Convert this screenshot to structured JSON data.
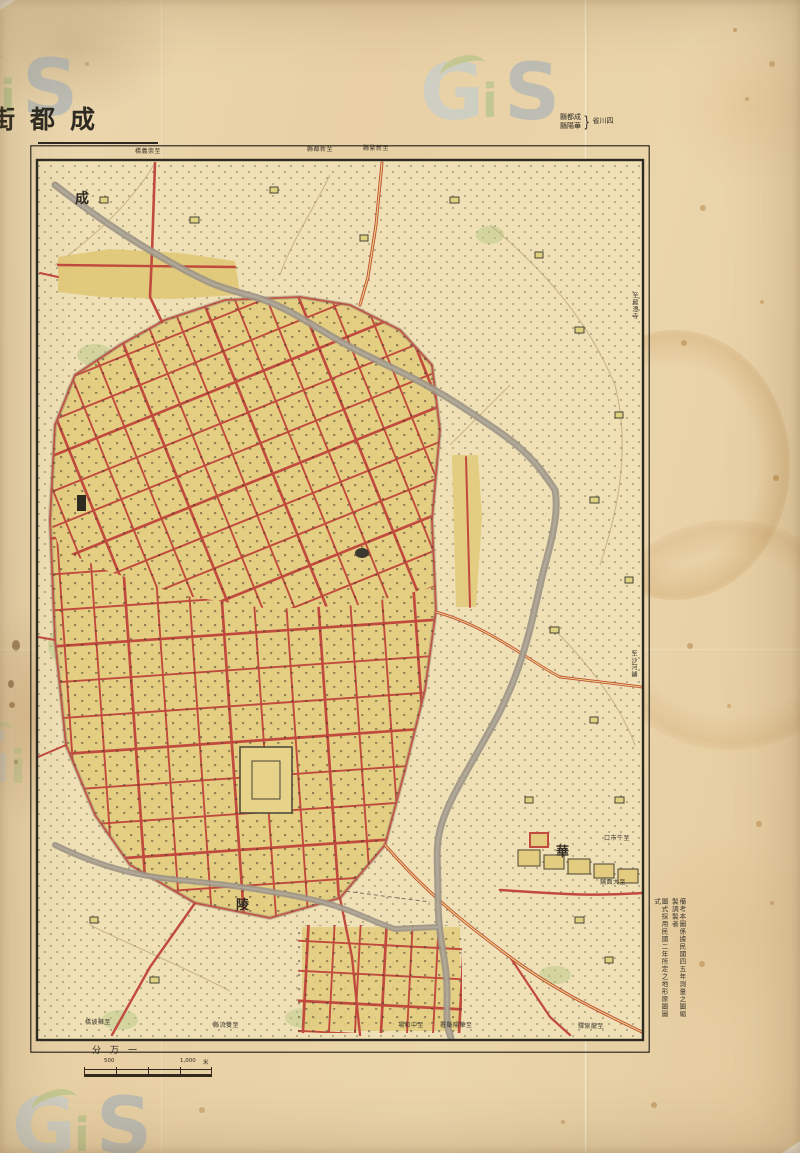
{
  "sheet": {
    "title_display": "街都成"
  },
  "header_note": {
    "counties_display": [
      "縣都成",
      "縣陽華"
    ],
    "brace": "}",
    "province_display": "省川四"
  },
  "watermark": {
    "g": "G",
    "i": "i",
    "s": "S"
  },
  "labels": {
    "large": [
      "成",
      "陵",
      "華"
    ],
    "top": [
      "橋義崇至",
      "縣都新至",
      "縣繁新至"
    ],
    "right_vertical": [
      "至龍潭寺",
      "至沙河鋪"
    ],
    "right_inner": [
      "口市牛至",
      "鋪面大至"
    ],
    "bottom": [
      "橋坡蘇至",
      "縣流雙至",
      "場和中至",
      "署縣陽華至",
      "驛泉龍至"
    ],
    "notes": [
      "備考本圖係據民國四五年測量之圖縮製調製者",
      "圖式採用民國二年所定之地形原圖圖式"
    ]
  },
  "scale": {
    "ratio_display": "分万一",
    "bar_mid": "500",
    "bar_end": "1,000",
    "unit": "米"
  },
  "colors": {
    "paper": "#e9d2a8",
    "map_ground": "#efe0b6",
    "street_red": "#c14a3e",
    "block_yellow": "#e3cc80",
    "river_gray": "#9c9486",
    "tree_green": "#b7c785",
    "ink": "#2e2a22",
    "watermark_blue": "#b5cde0",
    "watermark_green": "#9fbe7d",
    "watermark_steel": "#93a9bf"
  }
}
